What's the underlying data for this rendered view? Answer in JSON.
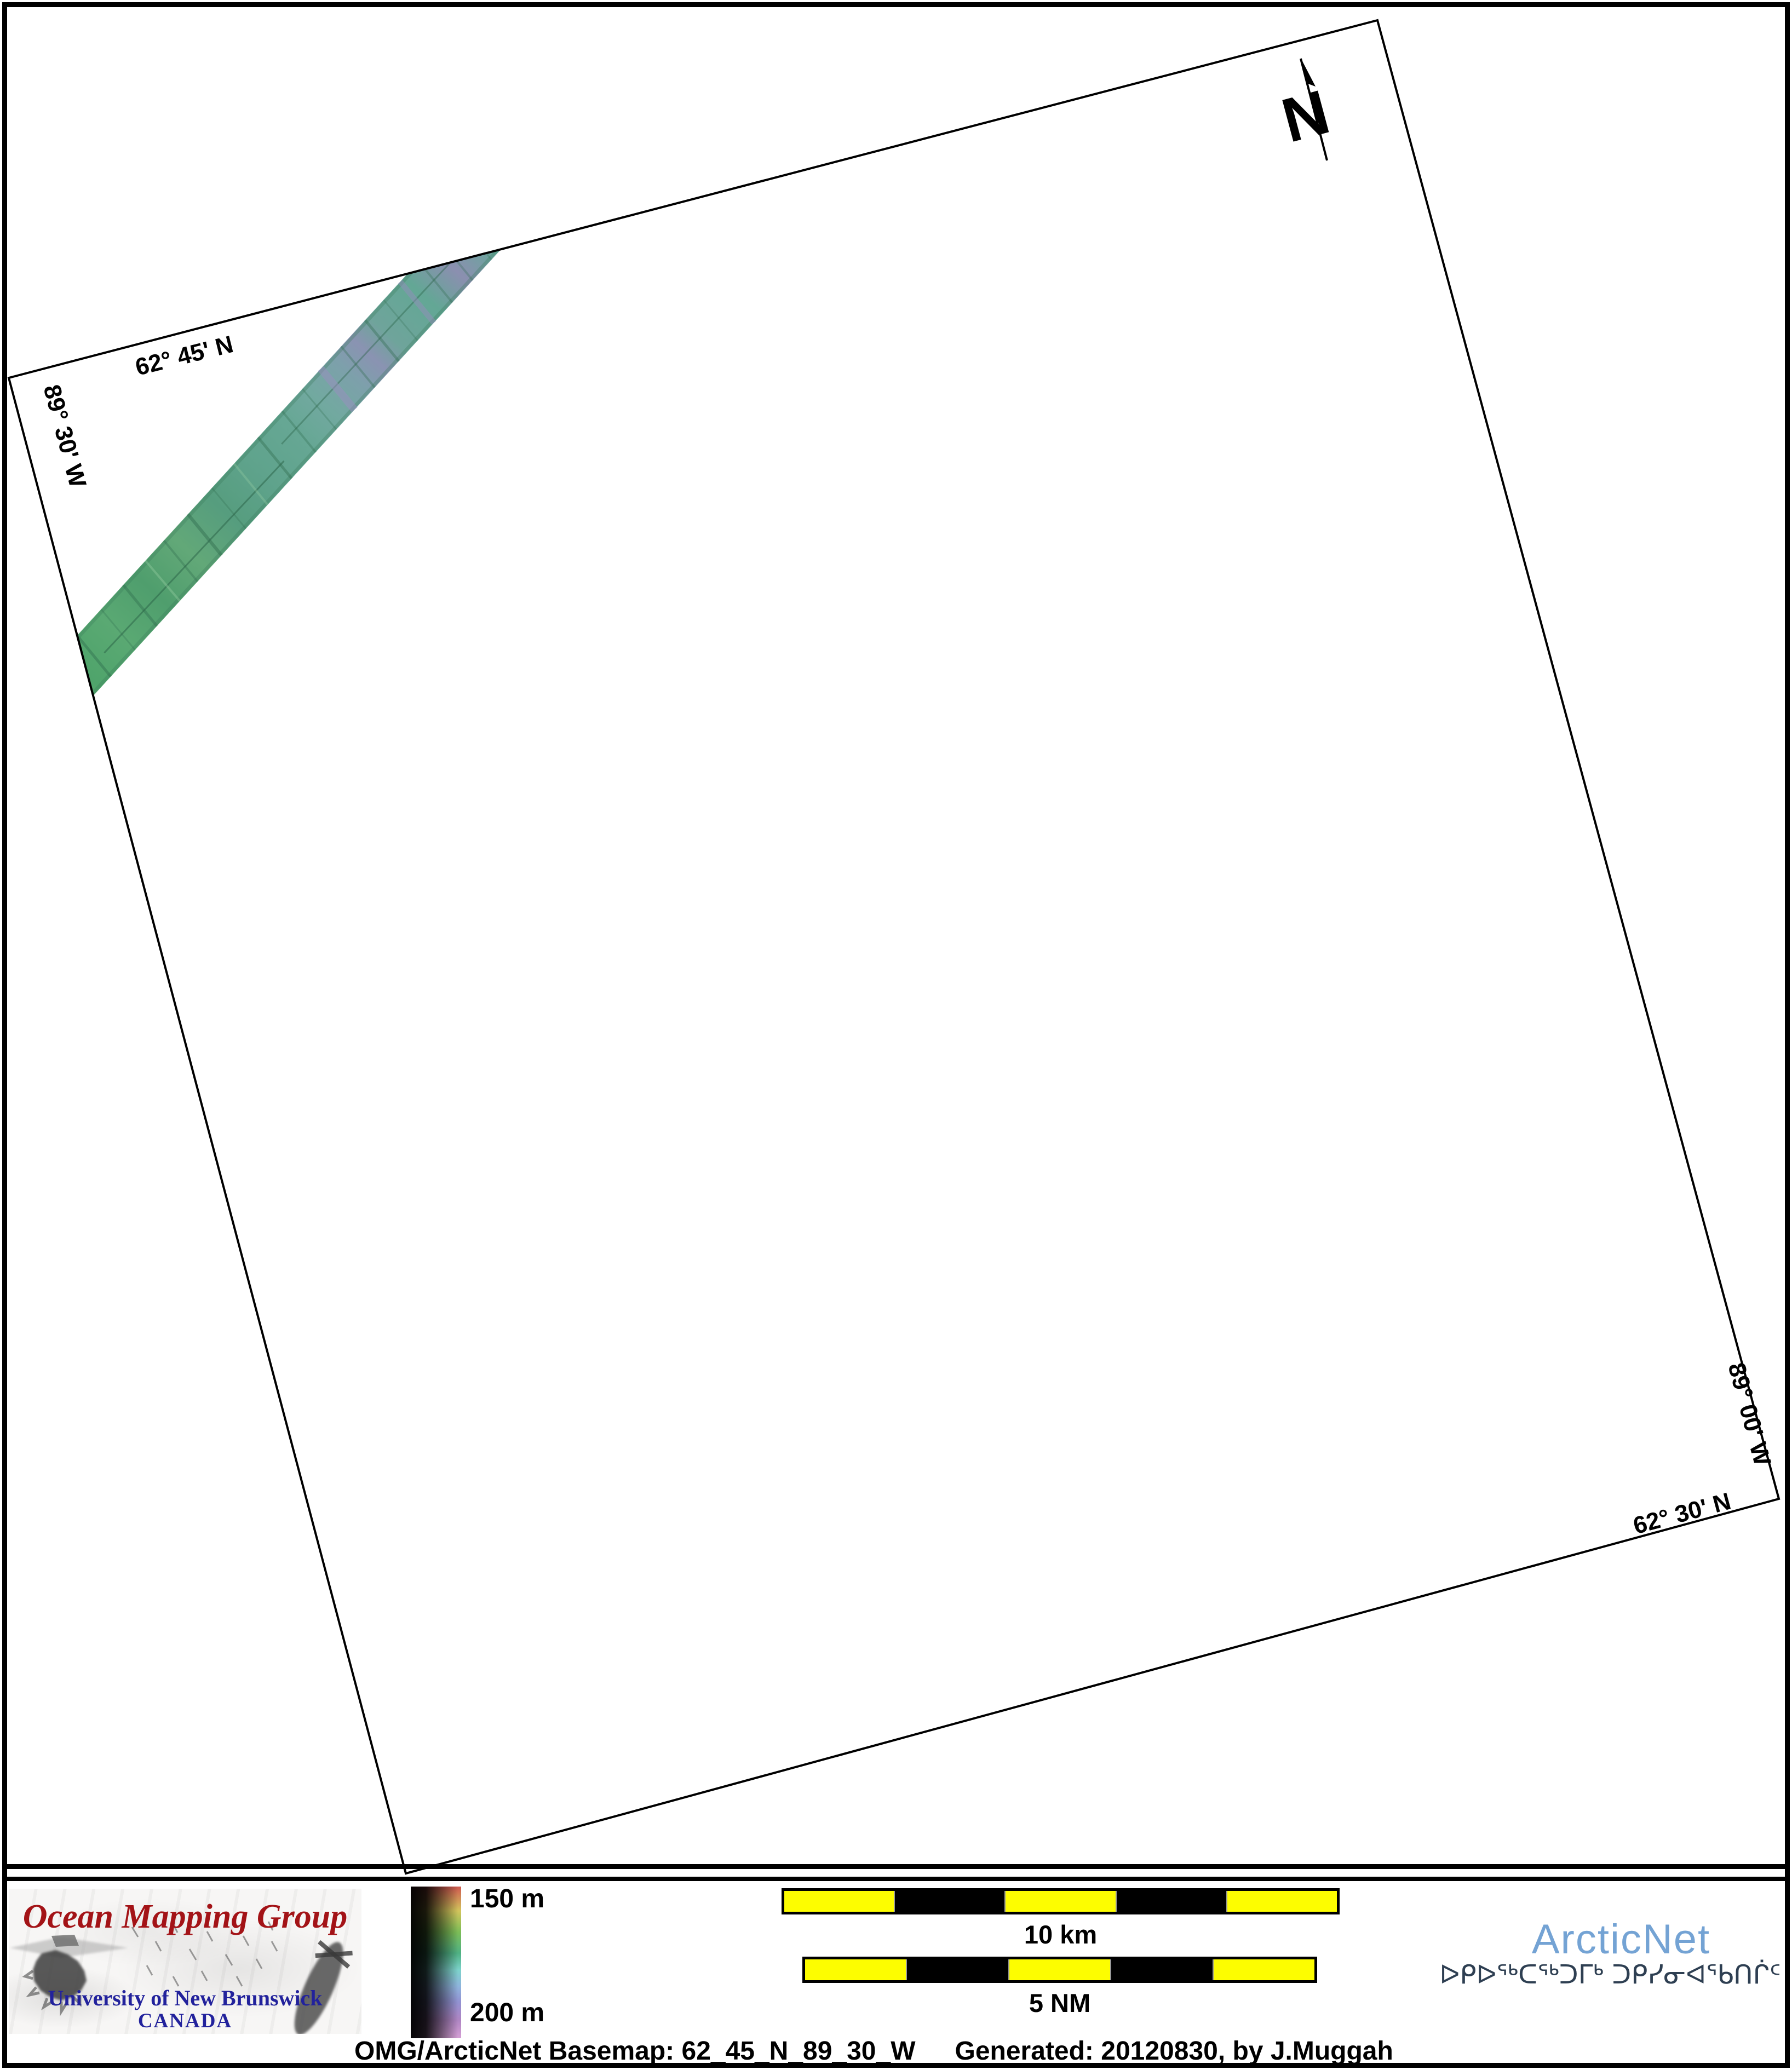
{
  "map": {
    "labels": {
      "top_lat": "62° 45' N",
      "west_lon": "89° 30' W",
      "east_lon": "89° 00' W",
      "bottom_lat": "62° 30' N"
    },
    "north": "N"
  },
  "depth_scale": {
    "top_label": "150 m",
    "bottom_label": "200 m"
  },
  "scale_bars": {
    "metric_label": "10 km",
    "nautical_label": "5 NM"
  },
  "omg_logo": {
    "title": "Ocean Mapping Group",
    "institution": "University of New Brunswick",
    "country": "CANADA"
  },
  "arcticnet_logo": {
    "name": "ArcticNet",
    "inuktitut_name": "ᐅᑭᐅᖅᑕᖅᑐᒥᒃ ᑐᑭᓯᓂᐊᖃᑎᒌᑦ"
  },
  "footer": {
    "basemap": "OMG/ArcticNet Basemap: 62_45_N_89_30_W",
    "generated": "Generated: 20120830, by J.Muggah"
  },
  "colors": {
    "scale_bar_yellow": "#fdfd00",
    "omg_red": "#a31317",
    "unb_blue": "#22229c",
    "arcticnet_blue": "#74a3d4",
    "inuktitut_navy": "#2e3f52",
    "swath_green": "#5aa478"
  }
}
